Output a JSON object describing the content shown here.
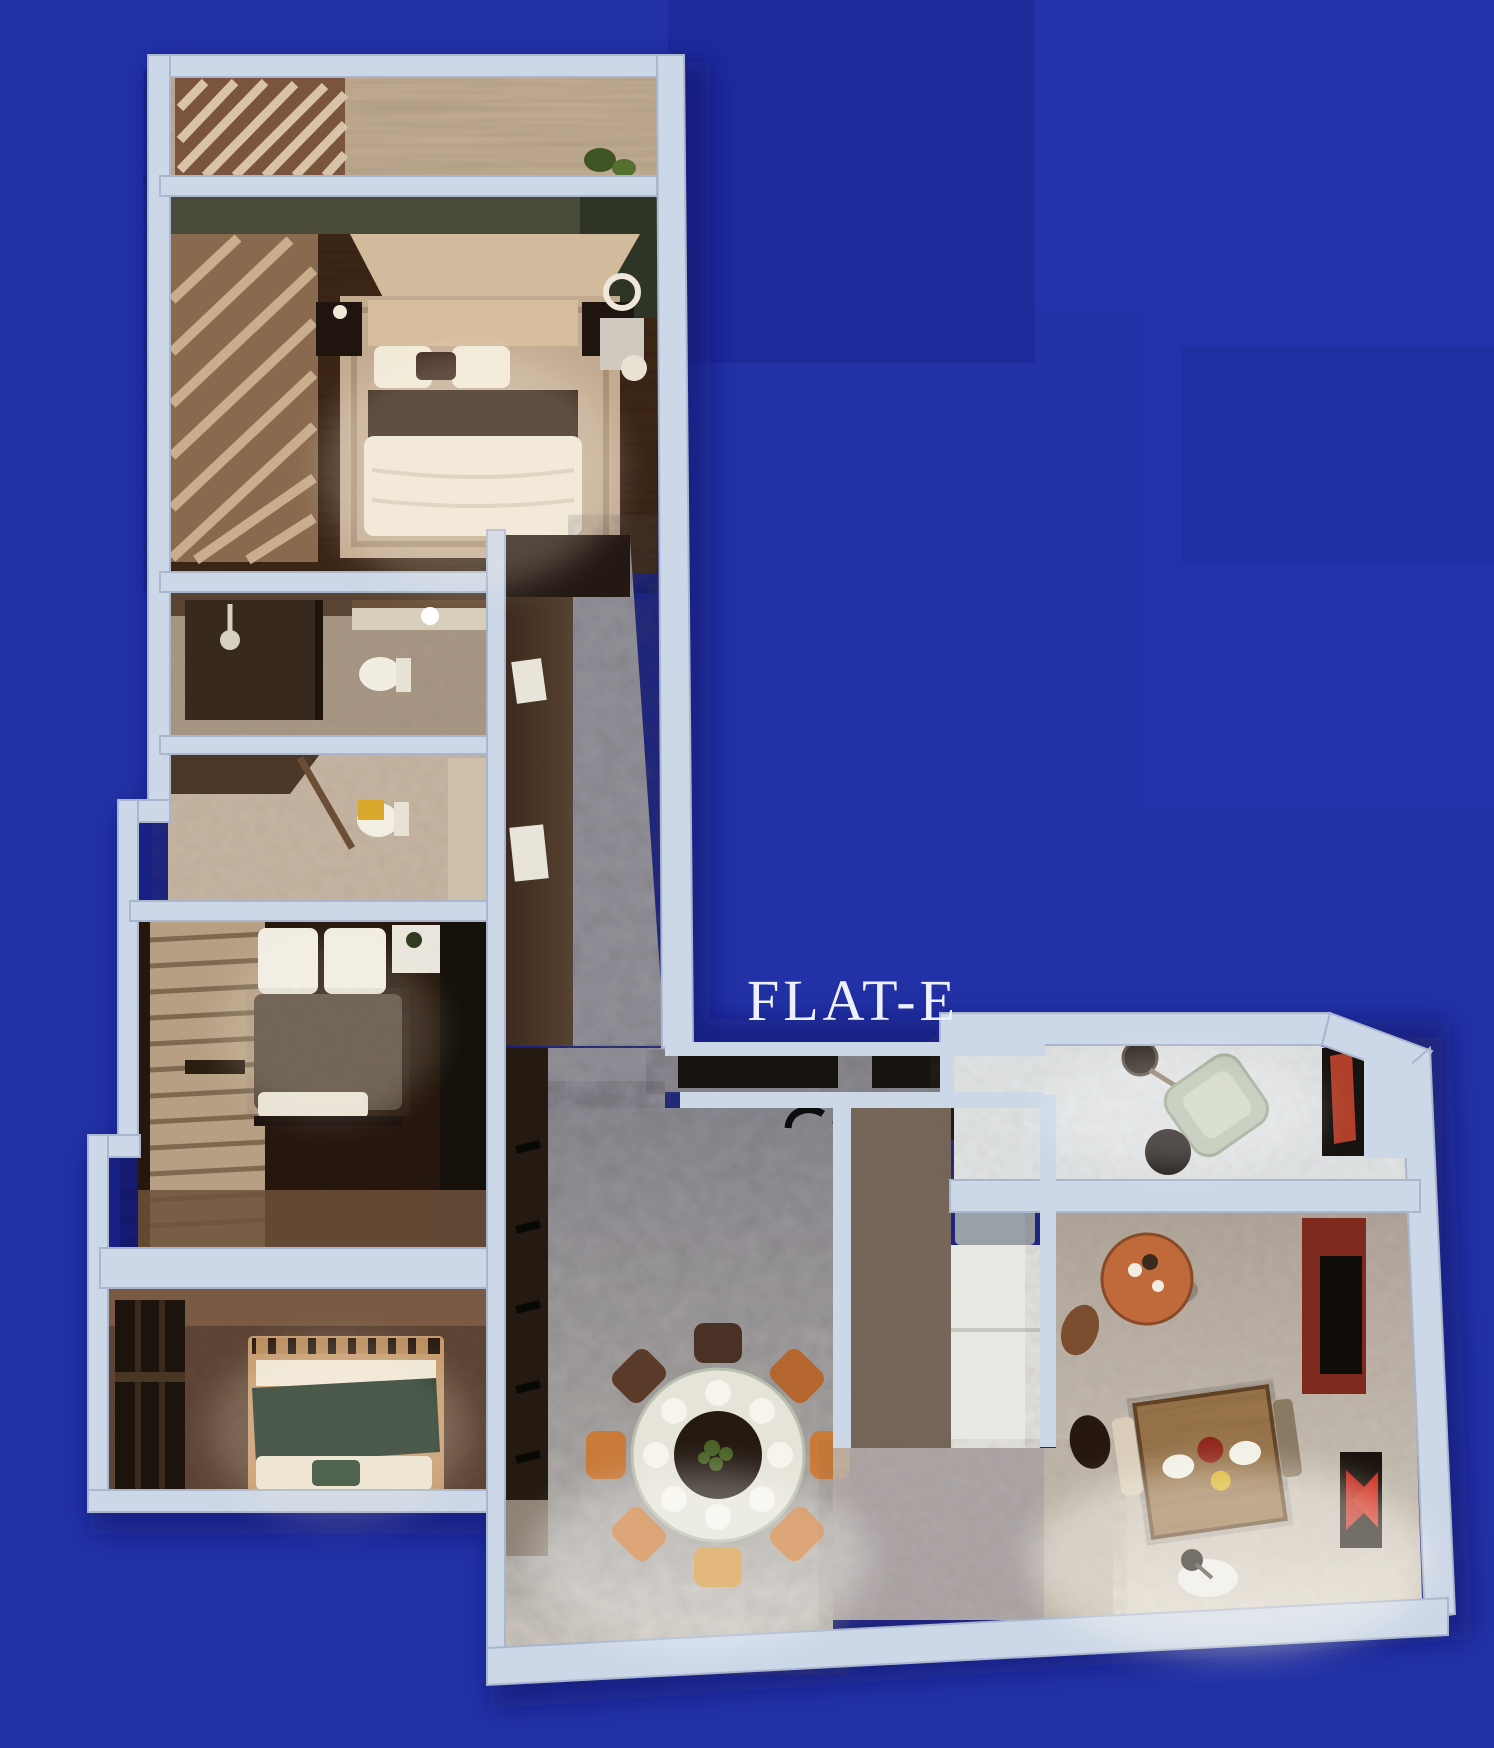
{
  "plan": {
    "label": "FLAT-E"
  },
  "colors": {
    "background": "#2232a6",
    "background_patch_dark": "#1d2b9b",
    "background_patch_right": "#2433ad",
    "wall": "#ccd7e7",
    "wall_shade": "#a9b6cd",
    "label_text": "#eef1fb",
    "floor_stone": "#97959c",
    "floor_wood_dark": "#41291e",
    "floor_wood_warm": "#5c4233",
    "accent_chair_orange": "#c97a38",
    "accent_table_terracotta": "#c06a3c",
    "accent_tv_red": "#7e2a1f",
    "accent_art_red": "#c0281c",
    "blanket_green": "#1e3526",
    "bed_linen": "#efe6d6",
    "towel_yellow": "#d8a92c"
  },
  "rooms": [
    {
      "id": "balcony",
      "features": [
        "slat-wardrobe",
        "plant"
      ]
    },
    {
      "id": "master-bedroom",
      "features": [
        "double-bed",
        "nightstands",
        "ceiling-light",
        "sphere-lamp"
      ]
    },
    {
      "id": "bathroom",
      "features": [
        "shower",
        "toilet",
        "vanity"
      ]
    },
    {
      "id": "wc",
      "features": [
        "toilet",
        "yellow-towel"
      ]
    },
    {
      "id": "bedroom-2",
      "features": [
        "bed-dark-duvet",
        "slat-wardrobe",
        "white-nightstand"
      ]
    },
    {
      "id": "bedroom-3",
      "features": [
        "bed-green-blanket",
        "dark-wardrobe"
      ]
    },
    {
      "id": "corridor",
      "features": [
        "wall-frames"
      ]
    },
    {
      "id": "dining-area",
      "features": [
        "round-table-8-chairs",
        "display-cabinet"
      ]
    },
    {
      "id": "kitchen",
      "features": [
        "sink-faucets",
        "counters",
        "fridge"
      ]
    },
    {
      "id": "study-nook",
      "features": [
        "armchair",
        "lamp",
        "red-wardrobe"
      ]
    },
    {
      "id": "living-room",
      "features": [
        "tv-red-panel",
        "coffee-table",
        "square-table",
        "floor-lamp",
        "red-artwork"
      ]
    }
  ]
}
